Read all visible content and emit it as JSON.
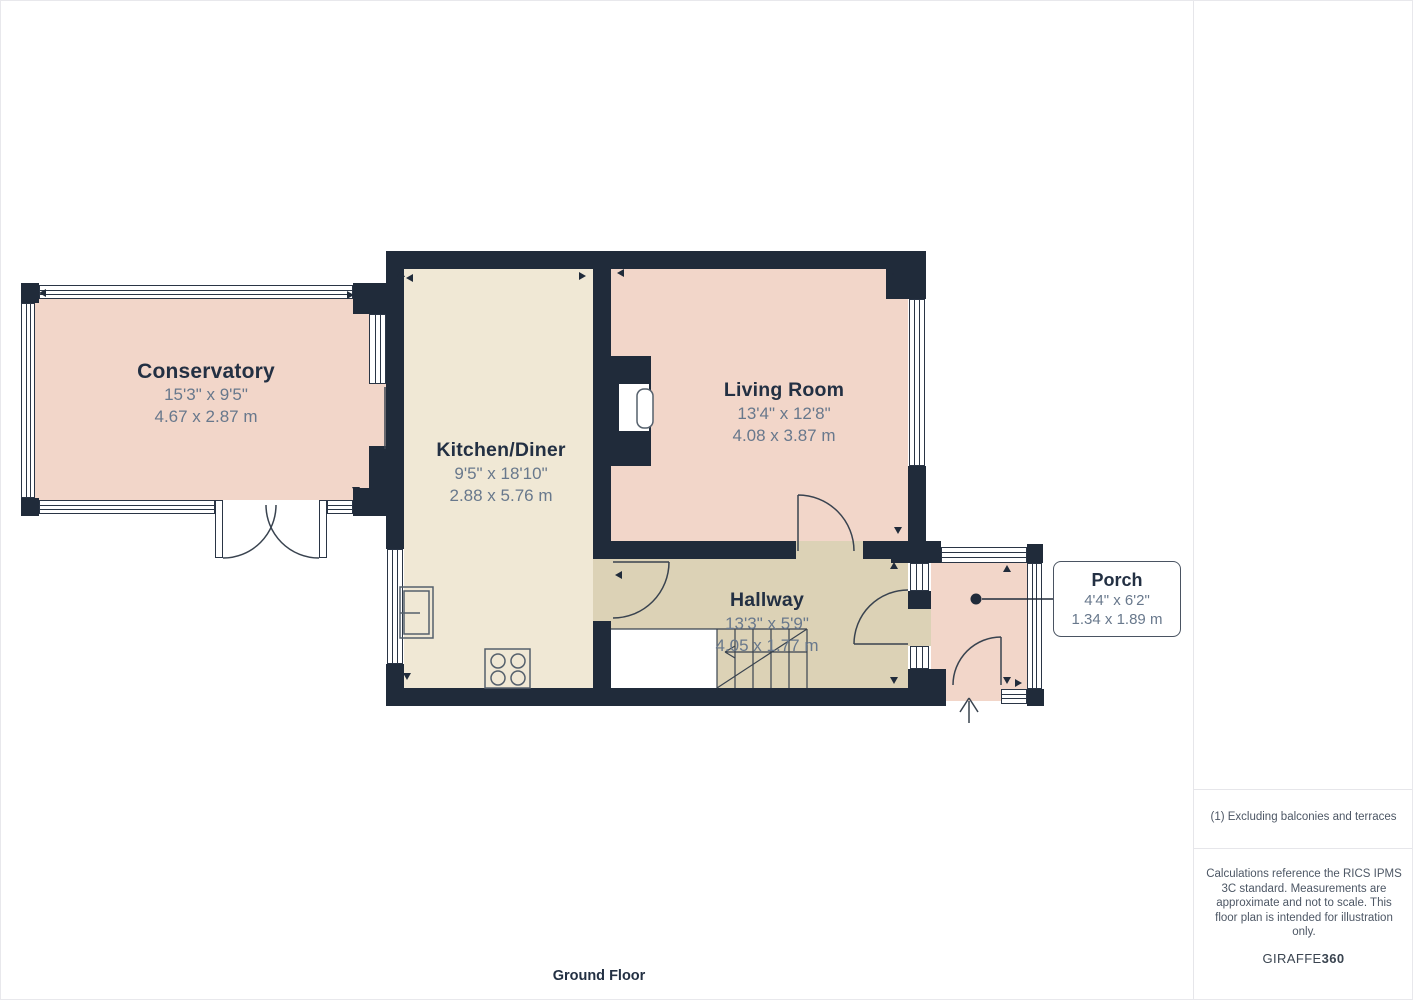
{
  "rooms": [
    {
      "name": "Conservatory",
      "imperial": "15'3\" x 9'5\"",
      "metric": "4.67 x 2.87 m"
    },
    {
      "name": "Kitchen/Diner",
      "imperial": "9'5\" x 18'10\"",
      "metric": "2.88 x 5.76 m"
    },
    {
      "name": "Living Room",
      "imperial": "13'4\" x 12'8\"",
      "metric": "4.08 x 3.87 m"
    },
    {
      "name": "Hallway",
      "imperial": "13'3\" x 5'9\"",
      "metric": "4.05 x 1.77 m"
    },
    {
      "name": "Porch",
      "imperial": "4'4\" x 6'2\"",
      "metric": "1.34 x 1.89 m"
    }
  ],
  "sidebar": {
    "area_title": "Approximate total area",
    "area_sup": "(1)",
    "area_ft": "603 ft²",
    "area_m": "55.9 m²",
    "footnote": "(1) Excluding balconies and terraces",
    "disclaimer": "Calculations reference the RICS IPMS 3C standard. Measurements are approximate and not to scale. This floor plan is intended for illustration only.",
    "brand_regular": "GIRAFFE",
    "brand_bold": "360"
  },
  "floor_label": "Ground Floor",
  "colors": {
    "wall": "#202b3a",
    "room_pink": "#f2d6c9",
    "room_cream": "#f0e8d5",
    "room_tan": "#dcd2b6",
    "label_navy": "#233043",
    "dimension_gray": "#68788c",
    "divider_gray": "#e6e6ea"
  }
}
